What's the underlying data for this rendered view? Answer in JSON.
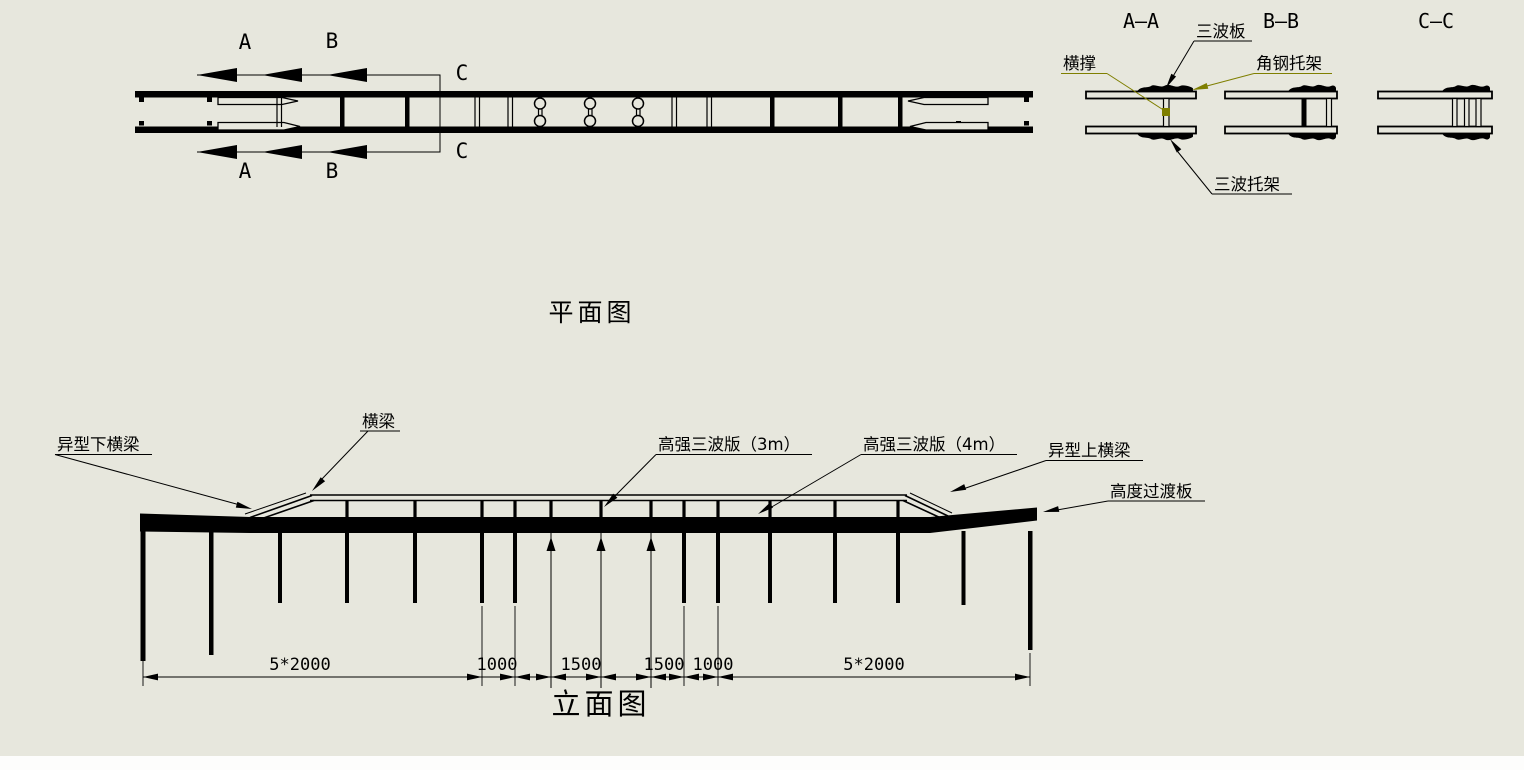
{
  "canvas": {
    "bg": "#e7e7dd",
    "line": "#000000",
    "accent": "#7f7f00"
  },
  "plan": {
    "title": "平面图",
    "markers": {
      "a": "A",
      "b": "B",
      "c": "C"
    }
  },
  "sections": {
    "aa_title": "A—A",
    "bb_title": "B—B",
    "cc_title": "C—C",
    "labels": {
      "sanbo_ban": "三波板",
      "hengcheng": "横撑",
      "jiaogang_tuojia": "角钢托架",
      "sanbo_tuojia": "三波托架"
    }
  },
  "elevation": {
    "title": "立面图",
    "labels": {
      "lower_beam": "异型下横梁",
      "beam": "横梁",
      "plate3m": "高强三波版（3m）",
      "plate4m": "高强三波版（4m）",
      "upper_beam": "异型上横梁",
      "transition": "高度过渡板"
    },
    "dims": [
      "5*2000",
      "1000",
      "1500",
      "1500",
      "1000",
      "5*2000"
    ]
  }
}
